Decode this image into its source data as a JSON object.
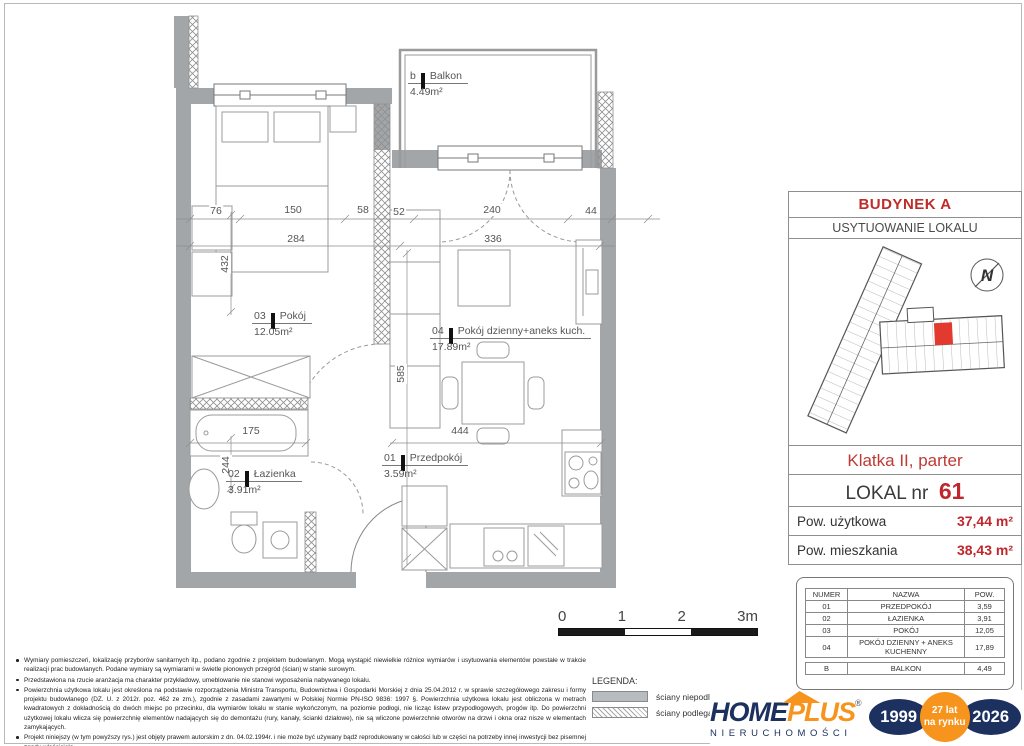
{
  "colors": {
    "accent_red": "#c0272d",
    "wall_gray": "#a3a6a8",
    "logo_navy": "#1d3160",
    "logo_orange": "#f7941e",
    "unit_red": "#e23a2e"
  },
  "plan": {
    "rooms": [
      {
        "num": "b",
        "name": "Balkon",
        "area": "4.49m²"
      },
      {
        "num": "03",
        "name": "Pokój",
        "area": "12.05m²"
      },
      {
        "num": "04",
        "name": "Pokój dzienny+aneks kuch.",
        "area": "17.89m²"
      },
      {
        "num": "02",
        "name": "Łazienka",
        "area": "3.91m²"
      },
      {
        "num": "01",
        "name": "Przedpokój",
        "area": "3.59m²"
      }
    ],
    "dims": [
      "76",
      "150",
      "58",
      "52",
      "240",
      "44",
      "284",
      "336",
      "432",
      "585",
      "244",
      "175",
      "444"
    ],
    "scale": [
      "0",
      "1",
      "2",
      "3m"
    ]
  },
  "panel": {
    "building": "BUDYNEK A",
    "location_title": "USYTUOWANIE LOKALU",
    "compass": "N",
    "staircase": "Klatka II, parter",
    "unit_label": "LOKAL nr",
    "unit_number": "61",
    "rows": [
      {
        "label": "Pow. użytkowa",
        "value": "37,44 m²"
      },
      {
        "label": "Pow. mieszkania",
        "value": "38,43 m²"
      }
    ],
    "table": {
      "headers": [
        "NUMER",
        "NAZWA",
        "POW."
      ],
      "rows": [
        [
          "01",
          "PRZEDPOKÓJ",
          "3,59"
        ],
        [
          "02",
          "ŁAZIENKA",
          "3,91"
        ],
        [
          "03",
          "POKÓJ",
          "12,05"
        ],
        [
          "04",
          "POKÓJ DZIENNY + ANEKS KUCHENNY",
          "17,89"
        ],
        [
          "",
          "",
          ""
        ],
        [
          "B",
          "BALKON",
          "4,49"
        ]
      ]
    }
  },
  "notes": [
    "Wymiary pomieszczeń, lokalizację przyborów sanitarnych itp., podano zgodnie z projektem budowlanym. Mogą wystąpić niewielkie różnice wymiarów i usytuowania elementów powstałe w trakcie realizacji prac budowlanych. Podane wymiary są wymiarami w świetle pionowych przegród (ścian) w stanie surowym.",
    "Przedstawiona na rzucie aranżacja ma charakter przykładowy, umeblowanie nie stanowi wyposażenia nabywanego lokalu.",
    "Powierzchnia użytkowa lokalu jest określona na podstawie rozporządzenia Ministra Transportu, Budownictwa i Gospodarki Morskiej z dnia 25.04.2012 r. w sprawie szczegółowego zakresu i formy projektu budowlanego (DZ. U. z 2012r. poz. 462 ze zm.), zgodnie z zasadami zawartymi w Polskiej Normie PN-ISO 9836: 1997 §. Powierzchnia użytkowa lokalu jest obliczona w metrach kwadratowych z dokładnością do dwóch miejsc po przecinku, dla wymiarów lokalu w stanie wykończonym, na poziomie podłogi, nie licząc listew przypodłogowych, progów itp. Do powierzchni użytkowej lokalu wlicza się powierzchnię elementów nadających się do demontażu (rury, kanały, ścianki działowe), nie są wliczone powierzchnie otworów na drzwi i okna oraz nisze w elementach zamykających.",
    "Projekt niniejszy (w tym powyższy rys.) jest objęty prawem autorskim z dn. 04.02.1994r. i nie może być używany bądź reprodukowany w całości lub w części na potrzeby innej inwestycji bez pisemnej zgody właściciela."
  ],
  "legend": {
    "title": "LEGENDA:",
    "items": [
      "ściany niepodlegające",
      "ściany podlegające mo"
    ]
  },
  "logo": {
    "home": "HOME",
    "plus": "PLUS",
    "reg": "®",
    "subtitle": "NIERUCHOMOŚCI",
    "year_start": "1999",
    "badge_top": "27 lat",
    "badge_bottom": "na rynku",
    "year_end": "2026"
  }
}
